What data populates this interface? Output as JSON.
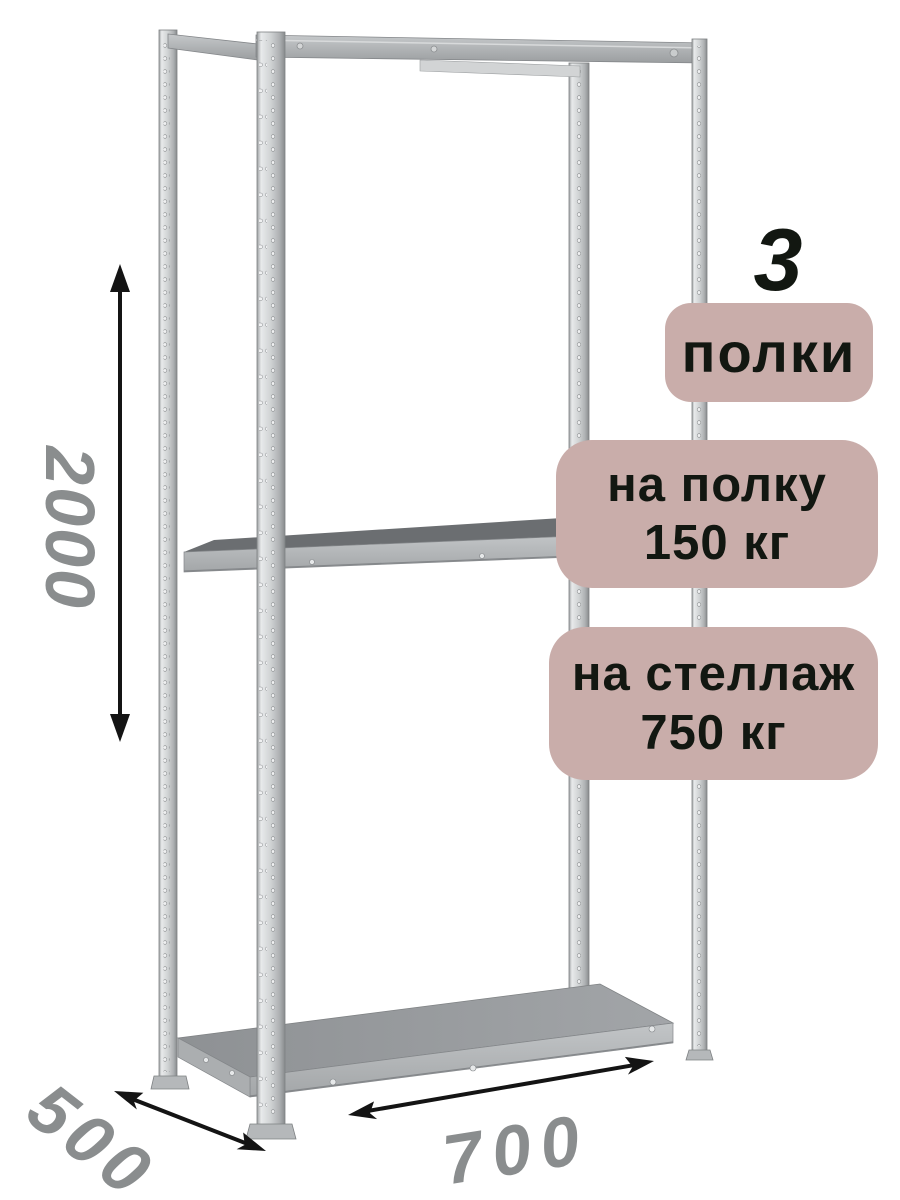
{
  "badges": {
    "shelf_count": {
      "number": "3",
      "label": "полки"
    },
    "shelf_load": {
      "line1": "на полку",
      "line2": "150 кг"
    },
    "rack_load": {
      "line1": "на стеллаж",
      "line2": "750 кг"
    }
  },
  "dimensions": {
    "height_mm": "2000",
    "depth_mm": "500",
    "width_mm": "700"
  },
  "colors": {
    "background": "#ffffff",
    "badge_background": "#c9adaa",
    "badge_text": "#121711",
    "dimension_label": "#8a8d8e",
    "arrow": "#141414",
    "metal_highlight": "#e8eaeb",
    "metal_base": "#c3c6c8",
    "metal_shadow": "#888b8d",
    "shelf_surface_dark": "#6b6e71",
    "shelf_surface_light": "#9aa0a3"
  }
}
